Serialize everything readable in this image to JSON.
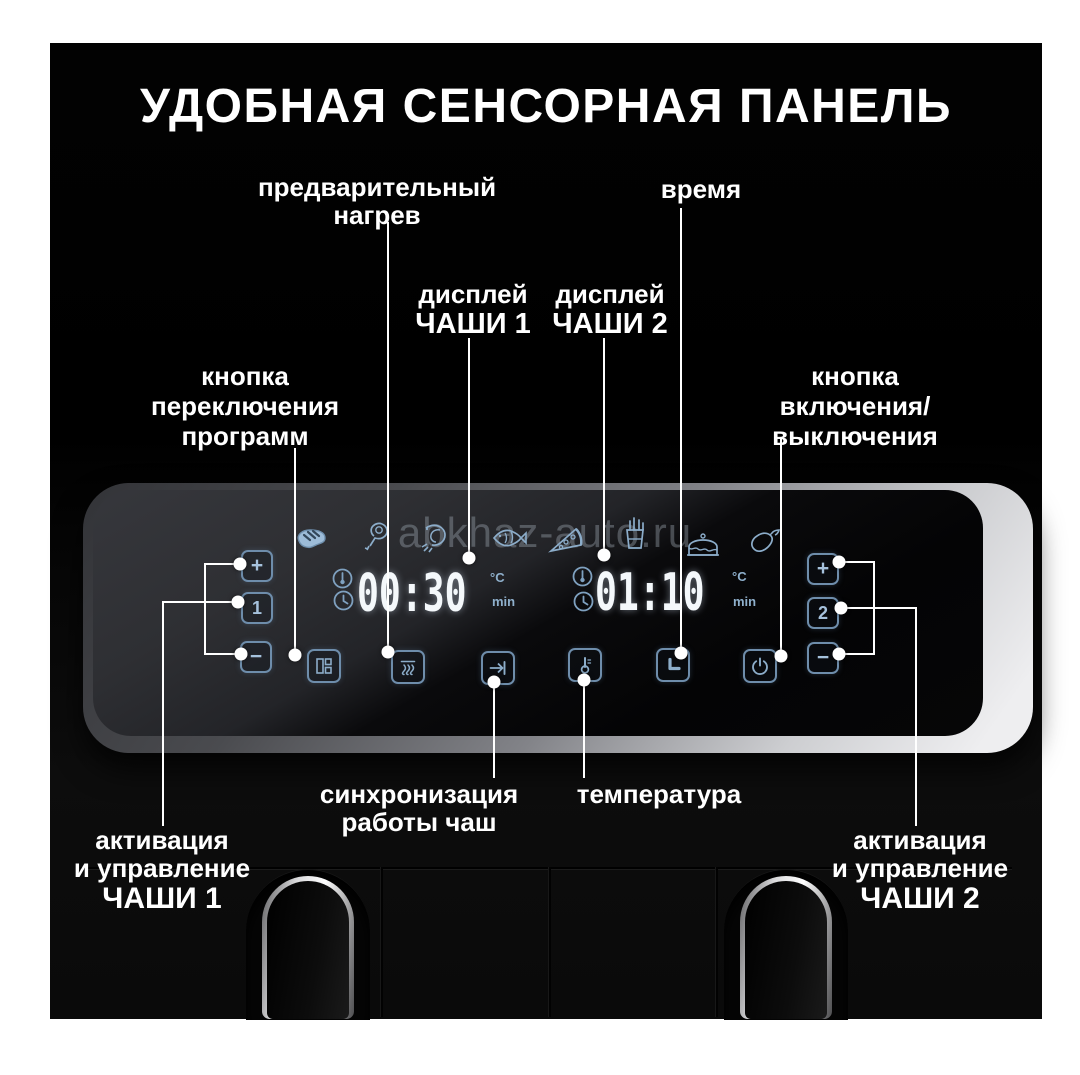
{
  "title": "УДОБНАЯ СЕНСОРНАЯ ПАНЕЛЬ",
  "watermark": "abkhaz-auto.ru",
  "callouts": {
    "preheat": {
      "line1": "предварительный",
      "line2": "нагрев"
    },
    "time": {
      "line1": "время"
    },
    "display1": {
      "line1": "дисплей",
      "line2": "ЧАШИ 1"
    },
    "display2": {
      "line1": "дисплей",
      "line2": "ЧАШИ 2"
    },
    "program": {
      "line1": "кнопка",
      "line2": "переключения",
      "line3": "программ"
    },
    "power": {
      "line1": "кнопка",
      "line2": "включения/",
      "line3": "выключения"
    },
    "sync": {
      "line1": "синхронизация",
      "line2": "работы чаш"
    },
    "temperature": {
      "line1": "температура"
    },
    "bowl1": {
      "line1": "активация",
      "line2": "и управление",
      "line3": "ЧАШИ 1"
    },
    "bowl2": {
      "line1": "активация",
      "line2": "и управление",
      "line3": "ЧАШИ 2"
    }
  },
  "panel": {
    "display1": {
      "value": "00:30",
      "temp_unit": "°C",
      "time_unit": "min"
    },
    "display2": {
      "value": "01:10",
      "temp_unit": "°C",
      "time_unit": "min"
    },
    "buttons": {
      "plus": "+",
      "minus": "−",
      "bowl1": "1",
      "bowl2": "2"
    },
    "food_icons": [
      "steak-icon",
      "chicken-leg-icon",
      "shrimp-icon",
      "fish-icon",
      "pizza-icon",
      "fries-icon",
      "cake-icon",
      "eggplant-icon"
    ],
    "function_icons": [
      "program-grid-icon",
      "preheat-icon",
      "sync-arrow-icon",
      "thermometer-icon",
      "clock-icon",
      "power-icon"
    ]
  },
  "colors": {
    "accent": "#7fa1c0",
    "digits": "#f4f8fb",
    "callout": "#ffffff",
    "watermark": "rgba(158,168,178,0.40)",
    "panel_rim": "#cdced1",
    "background": "#000000",
    "page": "#ffffff"
  }
}
